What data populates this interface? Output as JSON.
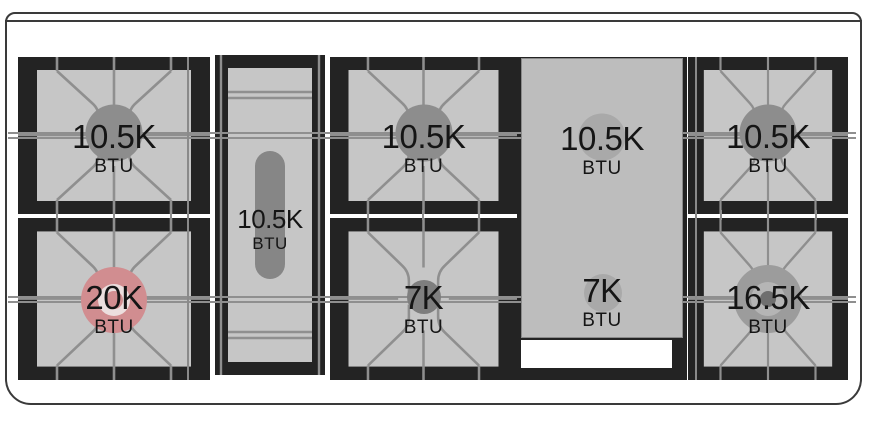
{
  "diagram": {
    "name": "range-cooktop-btu-diagram",
    "burners": {
      "left_rear": {
        "value": "10.5K",
        "unit": "BTU"
      },
      "left_front": {
        "value": "20K",
        "unit": "BTU",
        "highlighted": true
      },
      "center_oval": {
        "value": "10.5K",
        "unit": "BTU"
      },
      "middle_rear": {
        "value": "10.5K",
        "unit": "BTU"
      },
      "middle_front": {
        "value": "7K",
        "unit": "BTU"
      },
      "griddle_rear": {
        "value": "10.5K",
        "unit": "BTU"
      },
      "griddle_front": {
        "value": "7K",
        "unit": "BTU"
      },
      "right_rear": {
        "value": "10.5K",
        "unit": "BTU"
      },
      "right_front": {
        "value": "16.5K",
        "unit": "BTU"
      }
    },
    "colors": {
      "highlight": "#d18d90",
      "highlight_ring": "#ecdede",
      "grate_black": "#232323",
      "surface_light": "#c6c6c6",
      "griddle_plate": "#bdbdbd",
      "grate_line": "#8f8f8f",
      "cap_gray": "#8d8d8d",
      "frame_line": "#3a3a3a"
    }
  }
}
